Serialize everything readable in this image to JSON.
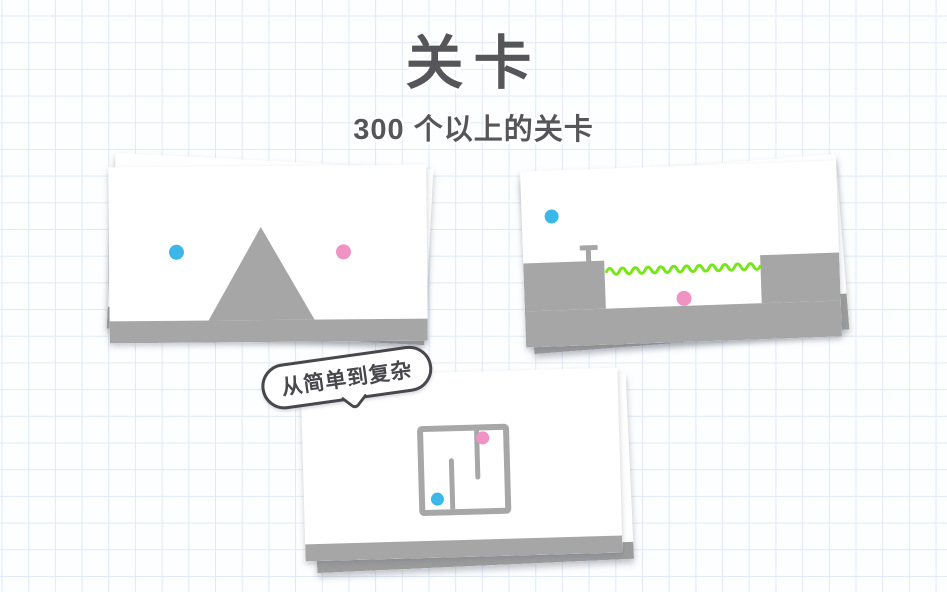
{
  "header": {
    "title": "关卡",
    "subtitle": "300 个以上的关卡"
  },
  "bubble": {
    "label": "从简单到复杂"
  },
  "colors": {
    "text_dark": "#56565a",
    "bubble_dark": "#48484c",
    "ball_blue": "#3bb7e8",
    "ball_pink": "#f092c3",
    "wave_green": "#76e619",
    "terrain_gray": "#a6a6a6",
    "grid_blue": "#dfeaf7"
  },
  "level_previews": [
    {
      "id": "triangle-hill",
      "balls": [
        "blue",
        "pink"
      ],
      "features": [
        "gray-floor",
        "triangle-hill"
      ]
    },
    {
      "id": "pit-with-wavy-line",
      "balls": [
        "blue",
        "pink"
      ],
      "features": [
        "gray-floor",
        "left-ledge",
        "right-ledge",
        "green-wavy-line",
        "t-shaped-peg"
      ]
    },
    {
      "id": "square-maze",
      "balls": [
        "blue",
        "pink"
      ],
      "features": [
        "gray-floor",
        "square-maze",
        "inner-wall-bottom",
        "inner-wall-top"
      ]
    }
  ]
}
